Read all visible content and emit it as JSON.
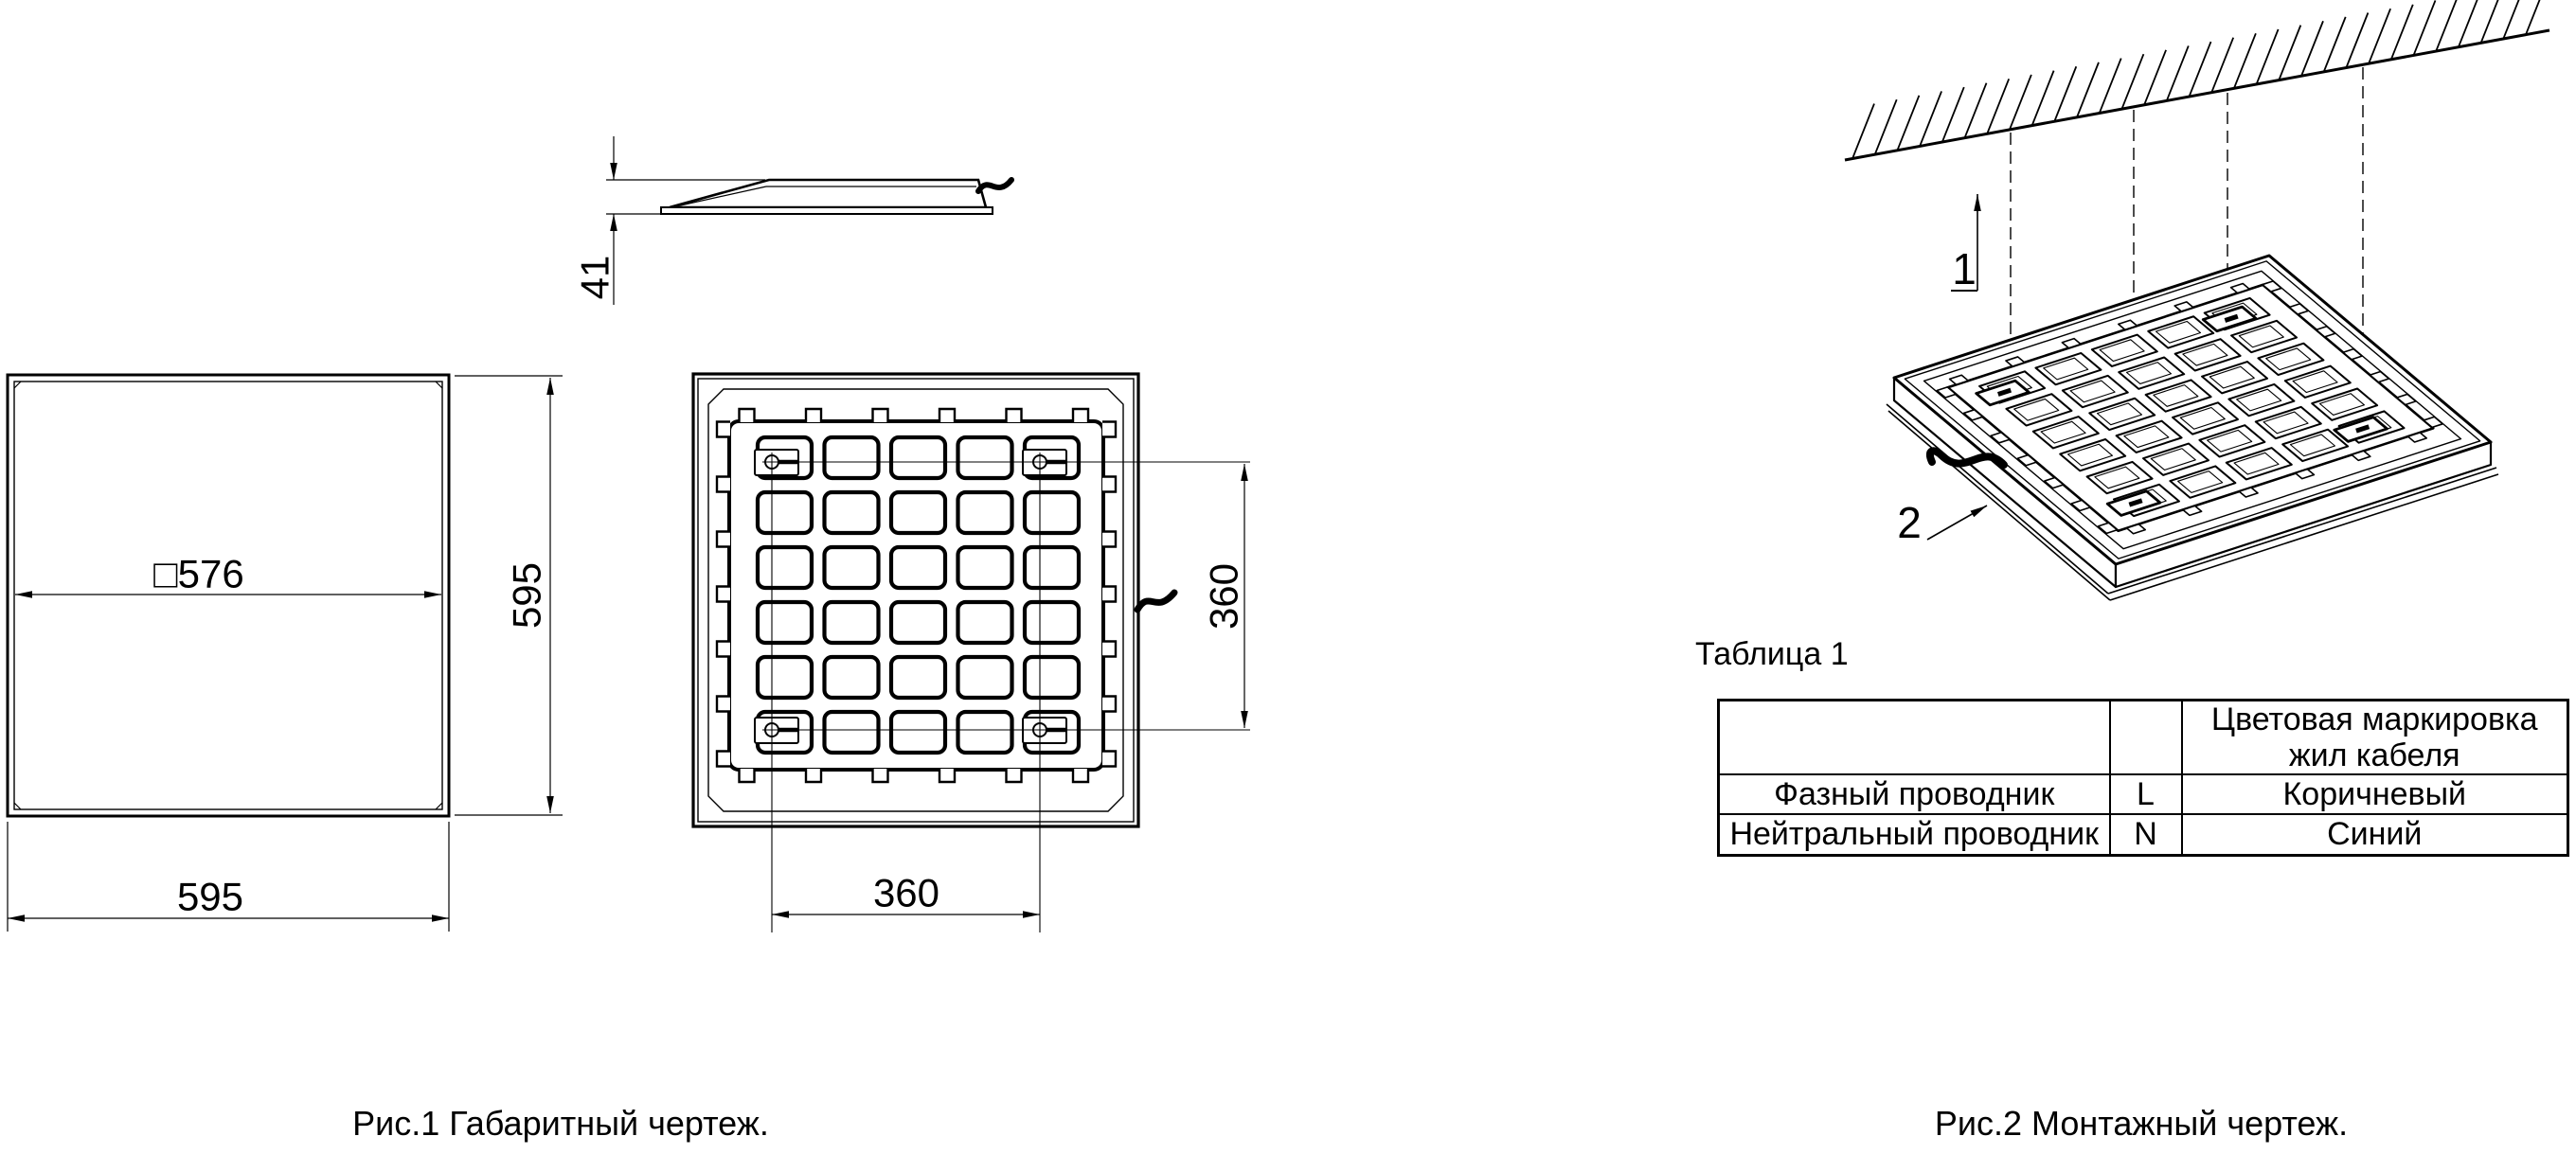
{
  "figure1": {
    "caption": "Рис.1 Габаритный чертеж.",
    "front_view": {
      "inner_width_label": "□576",
      "height_label": "595",
      "width_label": "595"
    },
    "profile_view": {
      "thickness_label": "41"
    },
    "back_view": {
      "mount_spacing_h_label": "360",
      "mount_spacing_v_label": "360"
    }
  },
  "figure2": {
    "caption": "Рис.2 Монтажный чертеж.",
    "callouts": {
      "suspension": "1",
      "panel": "2"
    }
  },
  "table1": {
    "title": "Таблица 1",
    "header": {
      "color_line1": "Цветовая маркировка",
      "color_line2": "жил кабеля"
    },
    "rows": [
      {
        "wire": "Фазный проводник",
        "terminal": "L",
        "color": "Коричневый"
      },
      {
        "wire": "Нейтральный проводник",
        "terminal": "N",
        "color": "Синий"
      }
    ]
  },
  "colors": {
    "line": "#000000",
    "background": "#ffffff"
  }
}
